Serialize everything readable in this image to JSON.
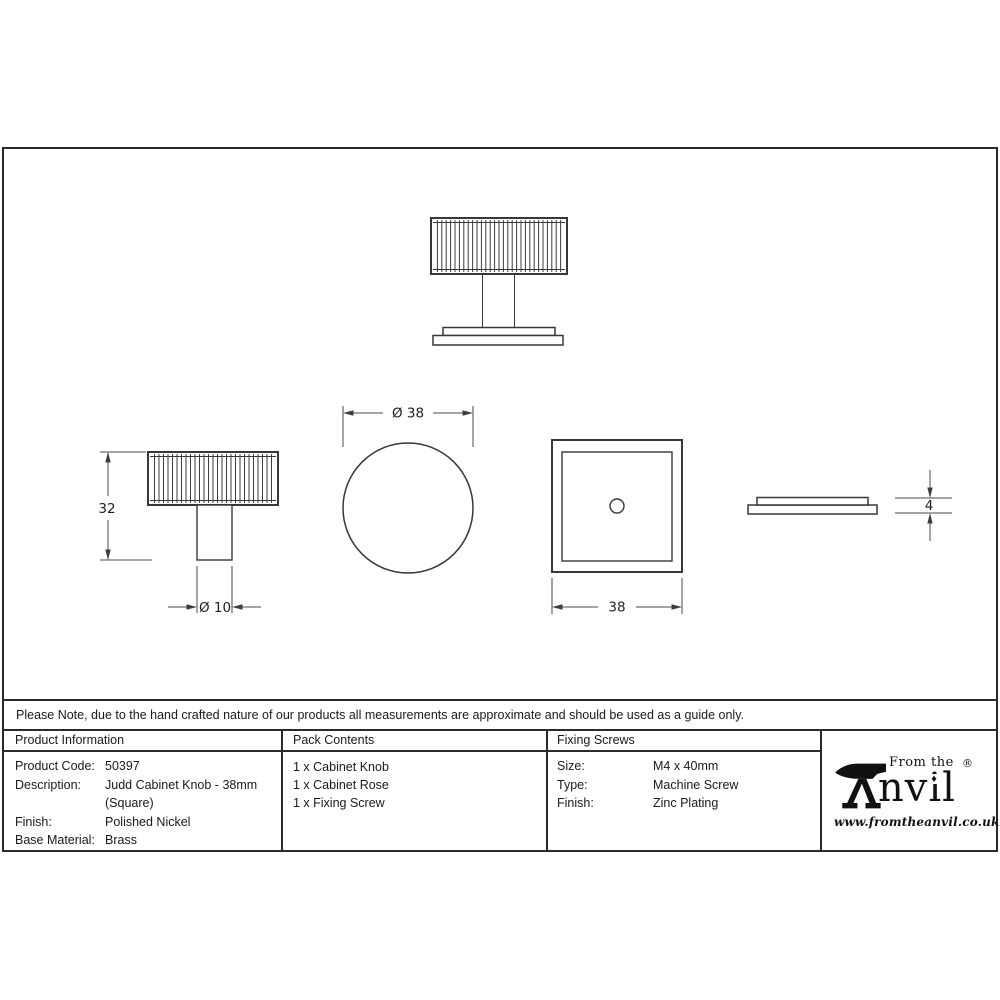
{
  "note": "Please Note, due to the hand crafted nature of our products all measurements are approximate and should be used as a guide only.",
  "drawings": {
    "dim_height": "32",
    "dim_stem_diameter": "Ø 10",
    "dim_knob_diameter": "Ø 38",
    "dim_rose_width": "38",
    "dim_rose_thickness": "4"
  },
  "table": {
    "product_information": {
      "header": "Product Information",
      "rows": [
        {
          "label": "Product Code:",
          "value": "50397"
        },
        {
          "label": "Description:",
          "value": "Judd Cabinet Knob - 38mm (Square)"
        },
        {
          "label": "Finish:",
          "value": "Polished Nickel"
        },
        {
          "label": "Base Material:",
          "value": "Brass"
        }
      ]
    },
    "pack_contents": {
      "header": "Pack Contents",
      "items": [
        "1 x Cabinet Knob",
        "1 x Cabinet Rose",
        "1 x Fixing Screw"
      ]
    },
    "fixing_screws": {
      "header": "Fixing Screws",
      "rows": [
        {
          "label": "Size:",
          "value": "M4 x 40mm"
        },
        {
          "label": "Type:",
          "value": "Machine Screw"
        },
        {
          "label": "Finish:",
          "value": "Zinc Plating"
        }
      ]
    }
  },
  "logo": {
    "tagline": "From the",
    "brand_text": "nvil",
    "diamond": "♦",
    "registered": "®",
    "website": "www.fromtheanvil.co.uk"
  },
  "colors": {
    "line": "#2b2b2b",
    "text": "#1a1a1a"
  }
}
